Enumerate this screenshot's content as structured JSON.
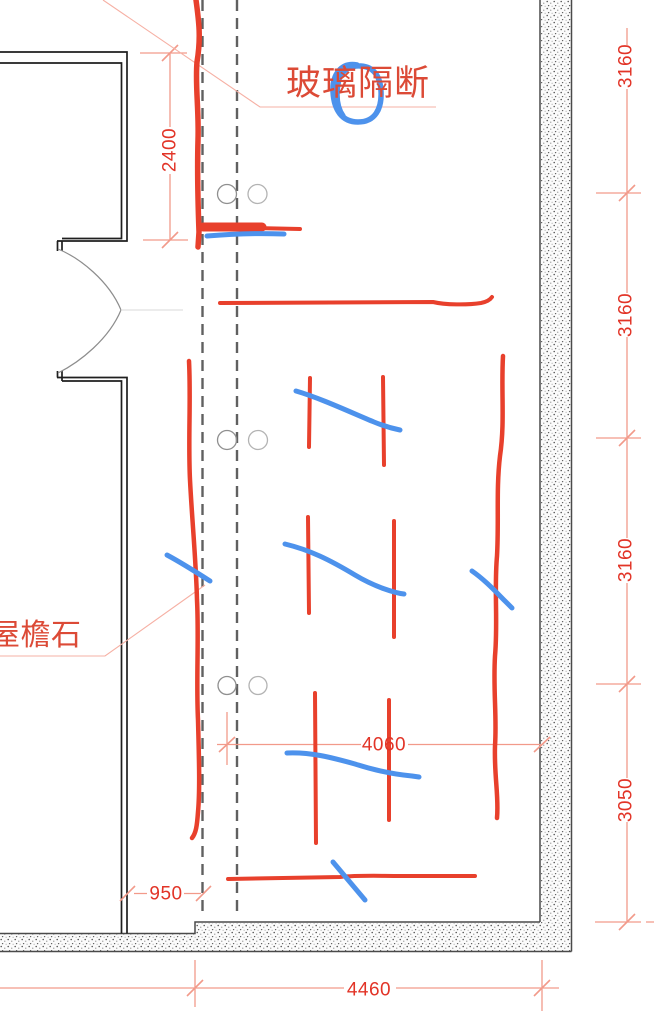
{
  "drawing": {
    "labels": {
      "glass_partition": "玻璃隔断",
      "eave_stone": "屋檐石"
    },
    "dimensions": {
      "left_vertical": "2400",
      "right_chain": [
        "3160",
        "3160",
        "3160",
        "3050"
      ],
      "inner_width": "4060",
      "offset": "950",
      "overall_width": "4460"
    },
    "colors": {
      "dimension_text_red": "#e23427",
      "dimension_line_pink": "#f29a8a",
      "markup_red": "#e8402c",
      "markup_blue": "#4d92ec",
      "wall_black": "#1f1f1f",
      "axis_gray": "#606060"
    }
  }
}
